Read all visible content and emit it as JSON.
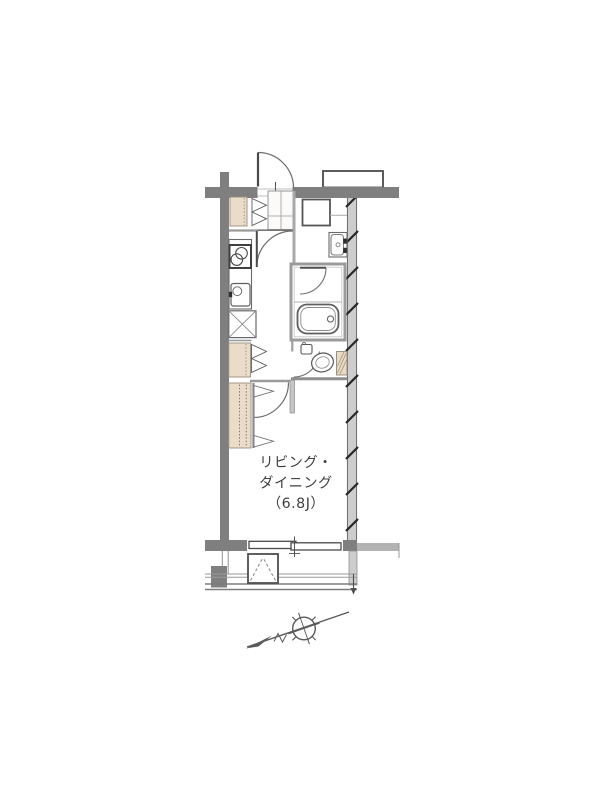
{
  "floorplan": {
    "living_label": {
      "line1": "リビング・",
      "line2": "ダイニング",
      "line3": "（6.8J）"
    },
    "colors": {
      "outer_wall": "#7f7f7f",
      "light_wall": "#cdcdcd",
      "fixture_beige": "#eadcc8",
      "line": "#4a4a4a",
      "background": "#ffffff"
    },
    "icons": [
      "north-arrow-icon"
    ]
  }
}
